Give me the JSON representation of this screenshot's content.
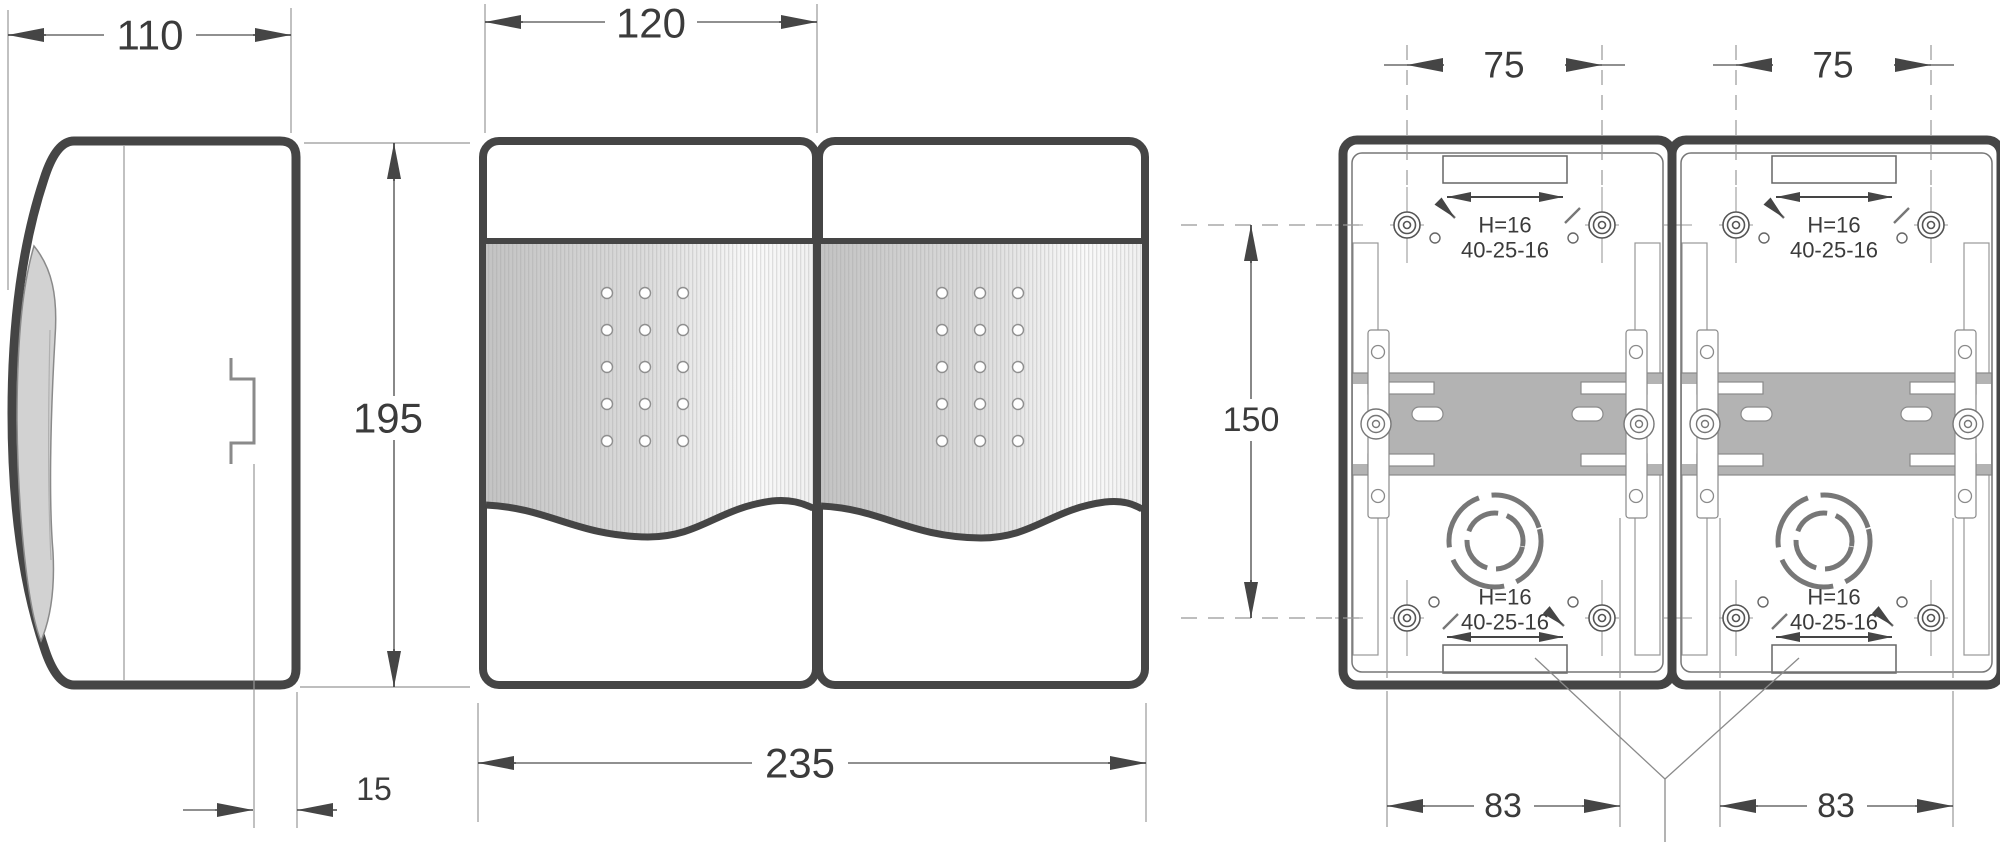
{
  "dimensions": {
    "side_overall_width": "110",
    "front_module_width": "120",
    "overall_height": "195",
    "rail_face_offset": "15",
    "front_overall_width": "235",
    "upper_mount_hole_spacing": "75",
    "vertical_mount_hole_spacing": "150",
    "lower_knockout_spacing": "83"
  },
  "notes": {
    "knockout_height": "H=16",
    "knockout_diameters": "40-25-16"
  },
  "colors": {
    "outline": "#454545",
    "thin_line": "#989898",
    "dim_line": "#6b6b6b",
    "text": "#3b3b3b",
    "door_fill": "#d2d2d2",
    "rail_fill": "#b3b3b3",
    "window_dark": "#c3c3c3"
  }
}
